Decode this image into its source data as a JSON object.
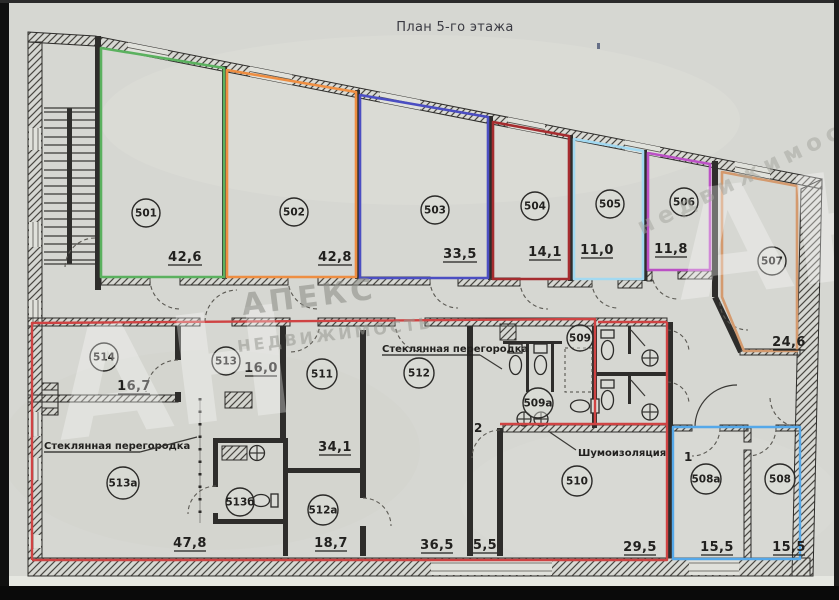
{
  "title": "План 5-го этажа",
  "rooms": [
    {
      "number": "501",
      "area": "42,6",
      "outline_color": "#5bb15f"
    },
    {
      "number": "502",
      "area": "42,8",
      "outline_color": "#ee8e42"
    },
    {
      "number": "503",
      "area": "33,5",
      "outline_color": "#4b4ec2"
    },
    {
      "number": "504",
      "area": "14,1",
      "outline_color": "#a52c2f"
    },
    {
      "number": "505",
      "area": "11,0",
      "outline_color": "#a2d9f1"
    },
    {
      "number": "506",
      "area": "11,8",
      "outline_color": "#bb50c5"
    },
    {
      "number": "507",
      "area": "24,6",
      "outline_color": "#d49a6e"
    },
    {
      "number": "508а",
      "area": "15,5"
    },
    {
      "number": "508",
      "area": "15,5"
    },
    {
      "number": "509"
    },
    {
      "number": "509а"
    },
    {
      "number": "510",
      "area": "29,5"
    },
    {
      "number": "511",
      "area": "34,1"
    },
    {
      "number": "512",
      "area": "36,5"
    },
    {
      "number": "512а",
      "area": "18,7"
    },
    {
      "number": "513",
      "area": "16,0"
    },
    {
      "number": "513а",
      "area": "47,8"
    },
    {
      "number": "513б"
    },
    {
      "number": "514",
      "area": "16,7"
    }
  ],
  "units": {
    "red_unit": {
      "outline_color": "#cf4343"
    },
    "blue_unit": {
      "outline_color": "#55a8e9"
    }
  },
  "annotations": {
    "glass_partition_left": "Стеклянная перегородка",
    "glass_partition_mid": "Стеклянная перегородка",
    "soundproofing": "Шумоизоляция",
    "door_mark_1": "1",
    "door_mark_2": "2",
    "corridor_area": "5,5"
  },
  "watermark": {
    "initials": "АН",
    "initials_right": "АН",
    "brand_name": "АПЕКС",
    "brand_tagline": "НЕДВИЖИМОСТЬ",
    "brand_tagline_small": "недвижимость"
  }
}
